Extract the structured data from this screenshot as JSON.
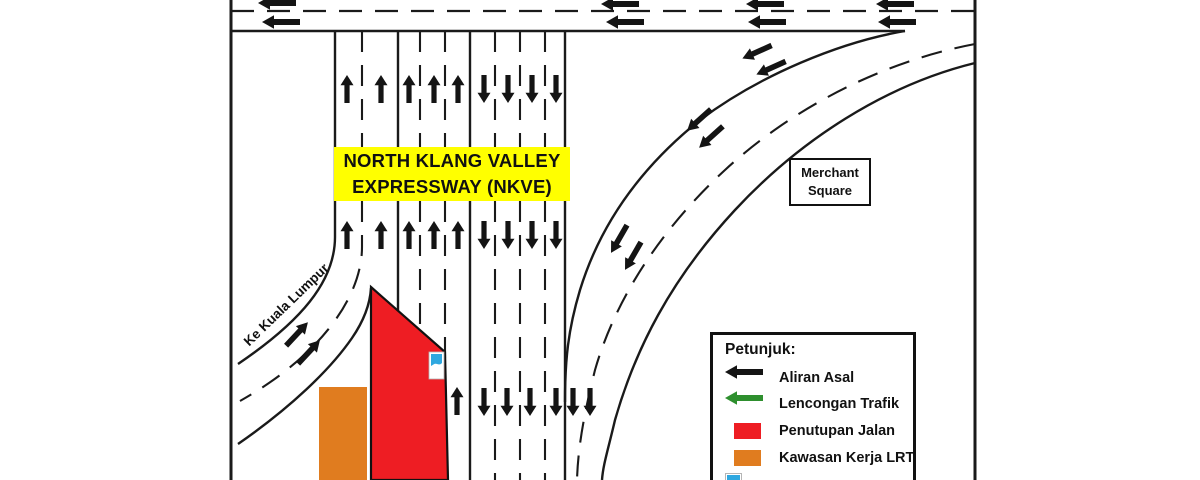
{
  "map": {
    "expressway_label": {
      "line1": "NORTH KLANG VALLEY",
      "line2": "EXPRESSWAY (NKVE)"
    },
    "merchant_square_label": {
      "line1": "Merchant",
      "line2": "Square"
    },
    "ke_kuala_lumpur_label": "Ke Kuala Lumpur"
  },
  "legend": {
    "title": "Petunjuk:",
    "items": [
      {
        "icon": "black-arrow-left-icon",
        "label": "Aliran Asal",
        "color": "#141414"
      },
      {
        "icon": "green-arrow-left-icon",
        "label": "Lencongan Trafik",
        "color": "#2E8F2E"
      },
      {
        "icon": "red-swatch-icon",
        "label": "Penutupan Jalan",
        "color": "#EE1D23"
      },
      {
        "icon": "orange-swatch-icon",
        "label": "Kawasan Kerja LRT3",
        "color": "#E07C1F"
      },
      {
        "icon": "blue-flag-icon",
        "label": "",
        "color": "#2FA8E0"
      }
    ]
  },
  "colors": {
    "road_line": "#1A1A1A",
    "closure_red": "#EE1D23",
    "work_zone_orange": "#E07C1F",
    "diversion_green": "#2E8F2E",
    "highlight_yellow": "#FFFF00",
    "flag_blue": "#2FA8E0"
  }
}
